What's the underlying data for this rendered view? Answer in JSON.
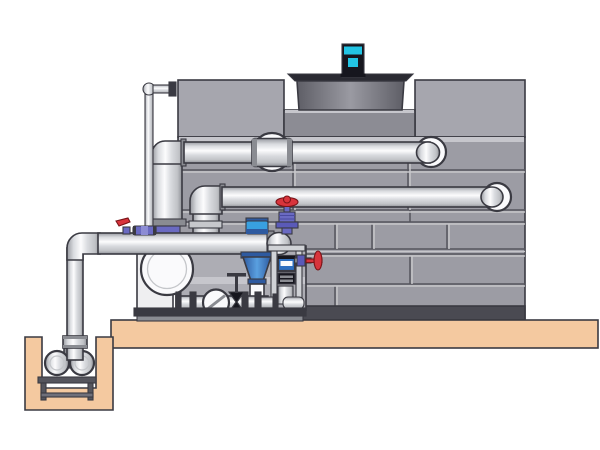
{
  "diagram": {
    "title": "Closed-circuit cooling tower with pump skid and sump pit - technical illustration",
    "background": "#FFFFFF"
  },
  "colors": {
    "outline": "#3A3A42",
    "tank_panel": "#9C9CA4",
    "tank_panel_light": "#A6A6AE",
    "tank_panel_dark": "#8C8C94",
    "tank_edge_dark": "#4A4A52",
    "tank_highlight": "#C6C6CC",
    "backdrop_gray": "#ADADB4",
    "fan_rim": "#2A2A32",
    "motor_cyan": "#22C4E4",
    "motor_body": "#16161E",
    "drum_edge": "#5E5E66",
    "drum_mid": "#9A9AA2",
    "pipe_edge": "#97999F",
    "pipe_lighter": "#D9DBDF",
    "pipe_white": "#FCFCFD",
    "pipe_shade": "#C0C2C6",
    "pipe_edge2": "#8F9197",
    "pipe_mid": "#C6C8CC",
    "platform_tan": "#F4C9A0",
    "stand_gray": "#55555D",
    "stand_light": "#70707A",
    "valve_red": "#D8343C",
    "valve_purple": "#6A6AC2",
    "valve_purple_dark": "#5A5AB8",
    "valve_purple_light": "#8C8CD4",
    "pump_blue": "#5AA0E0",
    "pump_blue_dark": "#2E5AA0",
    "coupling_blue": "#38A0E0",
    "instrument_blue": "#2E6FC0",
    "frame_gray": "#D0D2D6",
    "metal_dark": "#3A3A42",
    "metal_mid": "#8A8C92",
    "white_part": "#FAFAFC",
    "box_white": "#EFEFF1"
  },
  "components": {
    "fan_motor": "Fan motor",
    "fan_cowl": "Fan cowl",
    "tower_casing": "Cooling tower casing",
    "upper_pipe": "Upper return pipe",
    "middle_pipe": "Middle distribution pipe",
    "lower_pipe": "Suction header pipe",
    "makeup_line": "Make-up water line",
    "riser_pipe": "Riser pipe",
    "inline_pump": "Vertical inline pump",
    "volute_pump": "Centrifugal pump",
    "sump_pump": "Sump pump",
    "sump_pit": "Sump pit",
    "slab": "Concrete slab",
    "skid": "Pump skid base",
    "check_valve": "Check valve",
    "gate_valve": "Gate valve",
    "globe_valve_red": "Globe valve with red handwheel",
    "side_valve_red": "Side valve with red handwheel",
    "ball_valve_blue": "Ball valve",
    "lever_valve_red": "Lever valve",
    "instrument_panel": "Instrument unit",
    "support_frame": "Pipe support frame"
  }
}
